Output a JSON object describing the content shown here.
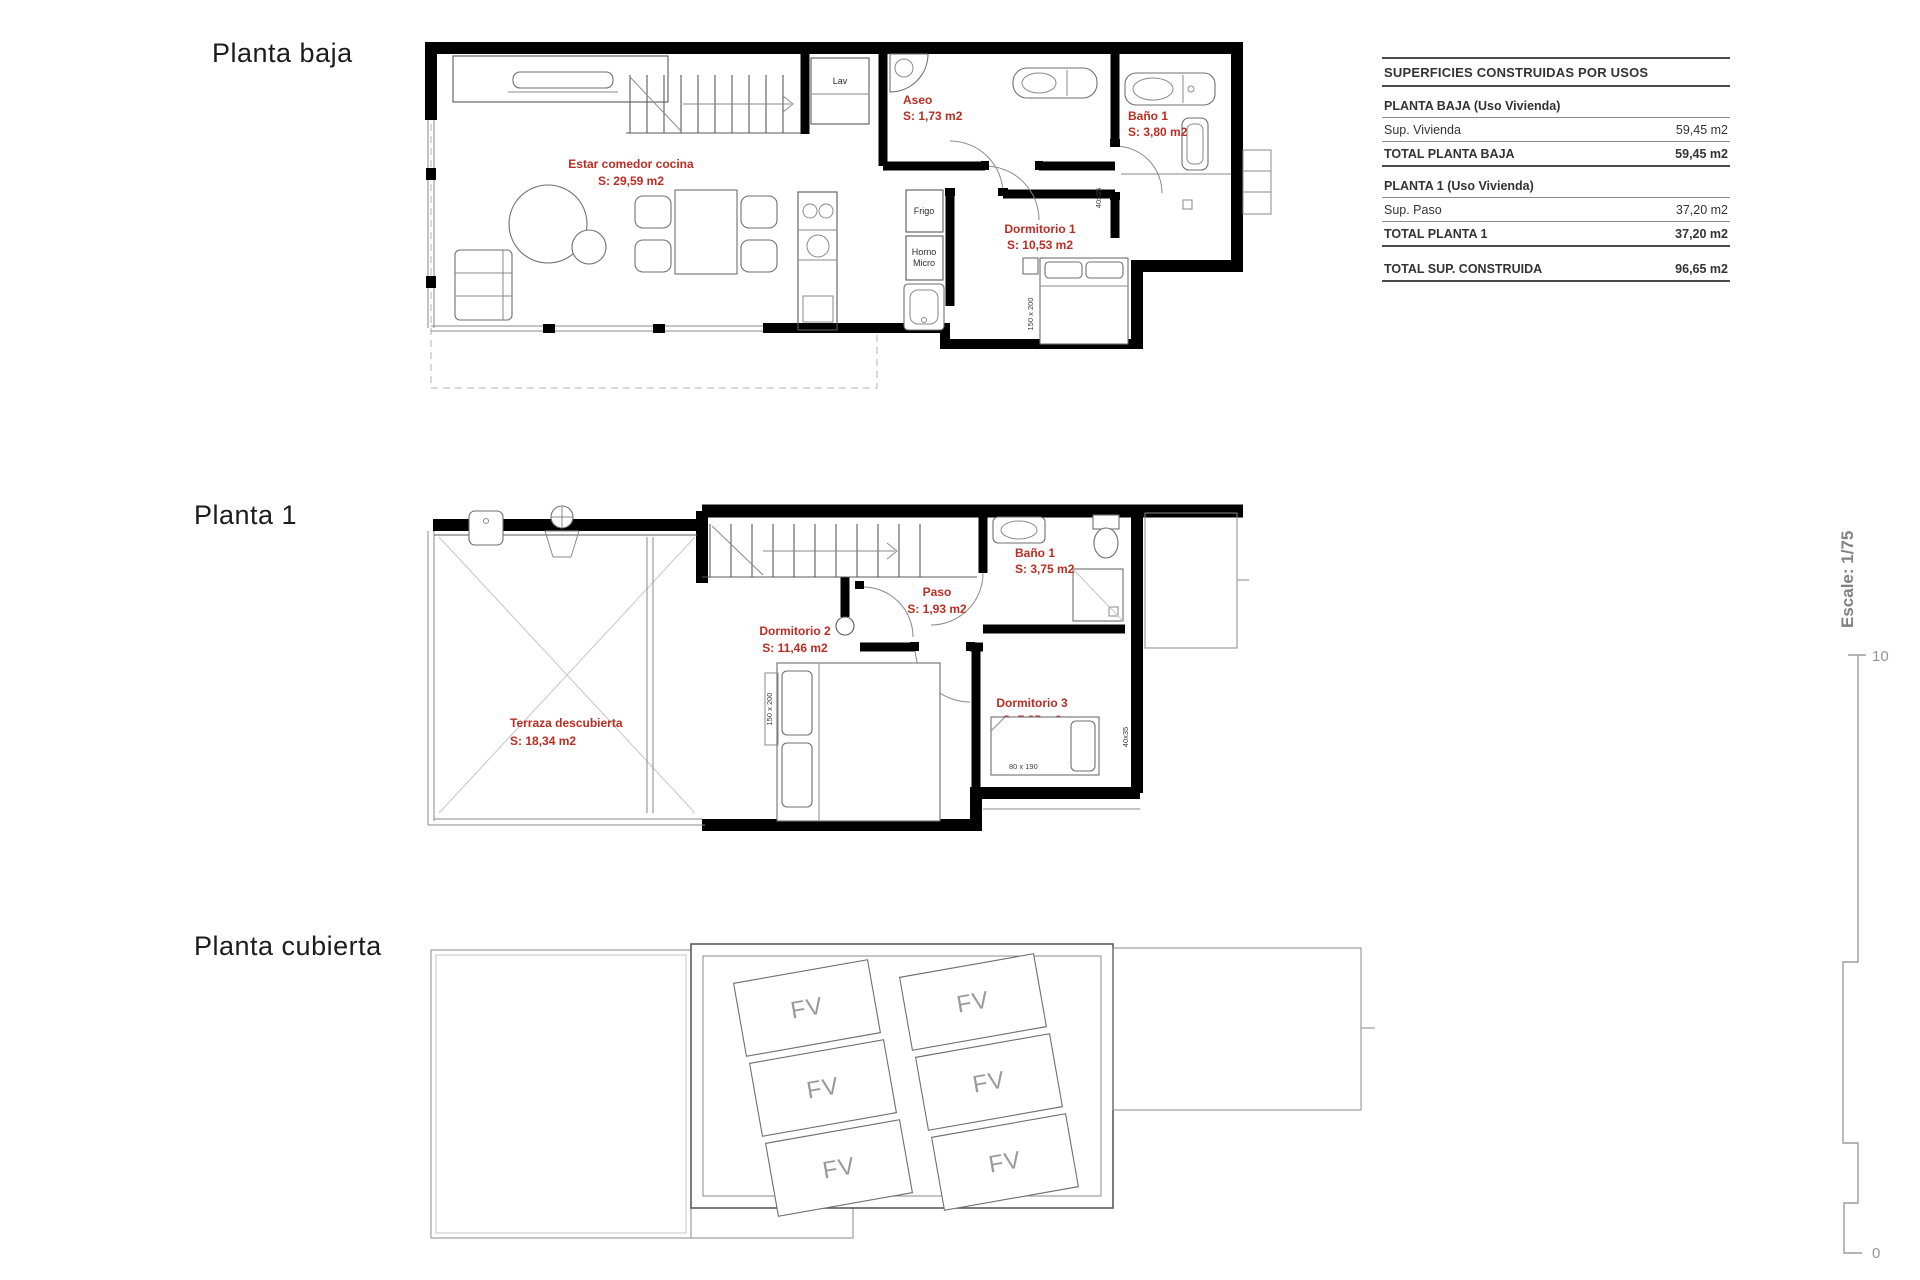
{
  "titles": {
    "planta_baja": "Planta baja",
    "planta_1": "Planta 1",
    "planta_cubierta": "Planta cubierta"
  },
  "colors": {
    "label_red": "#bb2d23",
    "wall_black": "#000000",
    "line_gray": "#8a8a8a",
    "fv_gray": "#9a9a9a"
  },
  "planta_baja": {
    "rooms": {
      "estar": {
        "name": "Estar comedor cocina",
        "area": "S: 29,59 m2"
      },
      "aseo": {
        "name": "Aseo",
        "area": "S: 1,73 m2"
      },
      "bano1": {
        "name": "Baño 1",
        "area": "S: 3,80 m2"
      },
      "dormitorio1": {
        "name": "Dormitorio 1",
        "area": "S: 10,53 m2"
      }
    },
    "fixtures": {
      "lav": "Lav",
      "frigo": "Frigo",
      "horno_line1": "Horno",
      "horno_line2": "Micro"
    },
    "dims": {
      "bed": "150 x 200",
      "window": "40x35"
    }
  },
  "planta_1": {
    "rooms": {
      "terraza": {
        "name": "Terraza descubierta",
        "area": "S: 18,34 m2"
      },
      "dormitorio2": {
        "name": "Dormitorio 2",
        "area": "S: 11,46 m2"
      },
      "paso": {
        "name": "Paso",
        "area": "S: 1,93 m2"
      },
      "bano1": {
        "name": "Baño 1",
        "area": "S: 3,75 m2"
      },
      "dormitorio3": {
        "name": "Dormitorio 3",
        "area": "S: 7,85 m2"
      }
    },
    "dims": {
      "bed_double": "150 x 200",
      "bed_single": "80 x 190",
      "window": "40x35"
    }
  },
  "planta_cubierta": {
    "panel_label": "FV"
  },
  "areas_table": {
    "title": "SUPERFICIES CONSTRUIDAS POR USOS",
    "sections": [
      {
        "header": "PLANTA BAJA (Uso Vivienda)",
        "rows": [
          {
            "label": "Sup. Vivienda",
            "value": "59,45 m2"
          },
          {
            "label": "TOTAL PLANTA BAJA",
            "value": "59,45 m2"
          }
        ]
      },
      {
        "header": "PLANTA 1 (Uso Vivienda)",
        "rows": [
          {
            "label": "Sup. Paso",
            "value": "37,20 m2"
          },
          {
            "label": "TOTAL PLANTA 1",
            "value": "37,20 m2"
          }
        ]
      }
    ],
    "total_row": {
      "label": "TOTAL SUP. CONSTRUIDA",
      "value": "96,65 m2"
    }
  },
  "scale": {
    "label": "Escale: 1/75",
    "top": "10",
    "bottom": "0"
  }
}
